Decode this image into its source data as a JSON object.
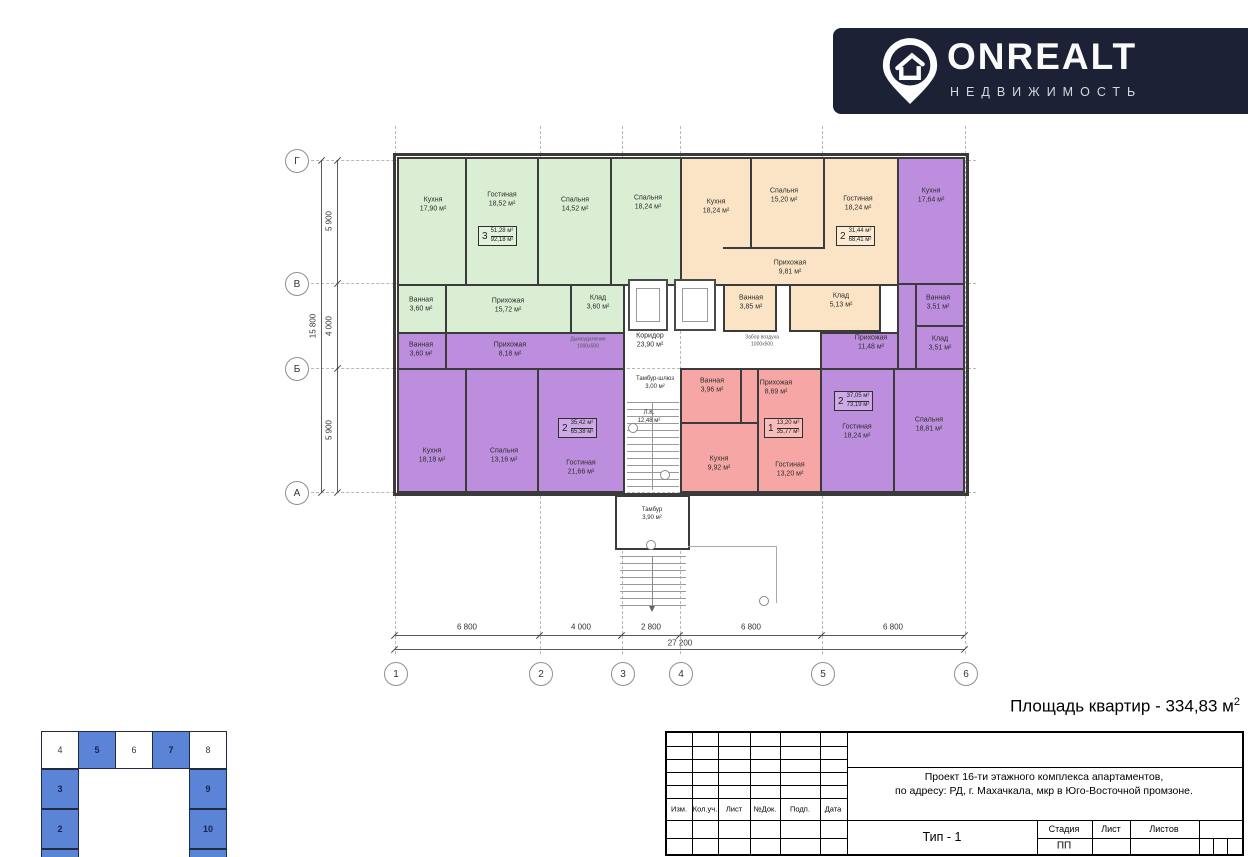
{
  "banner": {
    "brand": "ONREALT",
    "subtitle": "НЕДВИЖИМОСТЬ"
  },
  "summary": {
    "label": "Площадь квартир - 334,83 м",
    "sup": "2"
  },
  "palette": {
    "banner_navy": "#1d2135",
    "green": "#d9eed2",
    "peach": "#fbe4c6",
    "purple": "#bd8ede",
    "pink": "#f6a7a5",
    "minimap_blue": "#5b83d6",
    "wall": "#3b3b3b"
  },
  "plan": {
    "axes": {
      "rows": [
        "Г",
        "В",
        "Б",
        "А"
      ],
      "cols": [
        "1",
        "2",
        "3",
        "4",
        "5",
        "6"
      ]
    },
    "dims": {
      "h1": "6 800",
      "h2": "4 000",
      "h3": "2 800",
      "h4": "6 800",
      "h5": "6 800",
      "htotal": "27 200",
      "v1": "5 900",
      "v2": "4 000",
      "v3": "5 900",
      "vtotal": "15 800"
    },
    "rooms": {
      "g_kitchen": "Кухня\n17,90 м²",
      "g_living": "Гостиная\n18,52 м²",
      "g_bed1": "Спальня\n14,52 м²",
      "g_bed2": "Спальня\n18,24 м²",
      "g_bath": "Ванная\n3,60 м²",
      "g_hall": "Прихожая\n15,72 м²",
      "g_stor": "Клад\n3,60 м²",
      "o_kitchen": "Кухня\n18,24 м²",
      "o_bed": "Спальня\n15,20 м²",
      "o_living": "Гостиная\n18,24 м²",
      "o_hall": "Прихожая\n9,81 м²",
      "o_bath": "Ванная\n3,85 м²",
      "o_stor": "Клад\n5,13 м²",
      "pr_kitchen": "Кухня\n17,64 м²",
      "pr_bath": "Ванная\n3,51 м²",
      "pr_stor": "Клад\n3,51 м²",
      "pr_hall": "Прихожая\n11,48 м²",
      "pr_living": "Гостиная\n18,24 м²",
      "pr_bed": "Спальня\n18,81 м²",
      "pl_bath": "Ванная\n3,60 м²",
      "pl_hall": "Прихожая\n8,18 м²",
      "pl_kitchen": "Кухня\n18,18 м²",
      "pl_bed": "Спальня\n13,16 м²",
      "pl_living": "Гостиная\n21,66 м²",
      "r_bath": "Ванная\n3,96 м²",
      "r_hall": "Прихожая\n8,69 м²",
      "r_kitchen": "Кухня\n9,92 м²",
      "r_living": "Гостиная\n13,20 м²",
      "corridor": "Коридор\n23,90 м²",
      "tambour_lock": "Тамбур-шлюз\n3,00 м²",
      "stair": "Л.К.\n12,48 м²",
      "tambour": "Тамбур\n3,90 м²"
    },
    "annotations": {
      "smoke": "Дымоудаление\n1000х500",
      "air": "Забор воздуха\n1000х500"
    },
    "badges": {
      "green": {
        "n": "3",
        "a": "51,28 м²",
        "b": "92,18 м²"
      },
      "orange": {
        "n": "2",
        "a": "31,44 м²",
        "b": "68,41 м²"
      },
      "purple_left": {
        "n": "2",
        "a": "35,42 м²",
        "b": "65,38 м²"
      },
      "red": {
        "n": "1",
        "a": "13,20 м²",
        "b": "35,77 м²"
      },
      "purple_right": {
        "n": "2",
        "a": "37,05 м²",
        "b": "73,19 м²"
      }
    }
  },
  "minimap": {
    "c4": "4",
    "c5": "5",
    "c6": "6",
    "c7": "7",
    "c8": "8",
    "c3": "3",
    "c2": "2",
    "c9": "9",
    "c10": "10"
  },
  "titleblock": {
    "h1": "Изм.",
    "h2": "Кол.уч.",
    "h3": "Лист",
    "h4": "№Док.",
    "h5": "Подп.",
    "h6": "Дата",
    "project1": "Проект 16-ти этажного комплекса апартаментов,",
    "project2": "по адресу: РД, г. Махачкала, мкр в Юго-Восточной промзоне.",
    "type": "Тип - 1",
    "stage": "Стадия",
    "sheet": "Лист",
    "sheets": "Листов",
    "stage_value": "ПП"
  }
}
